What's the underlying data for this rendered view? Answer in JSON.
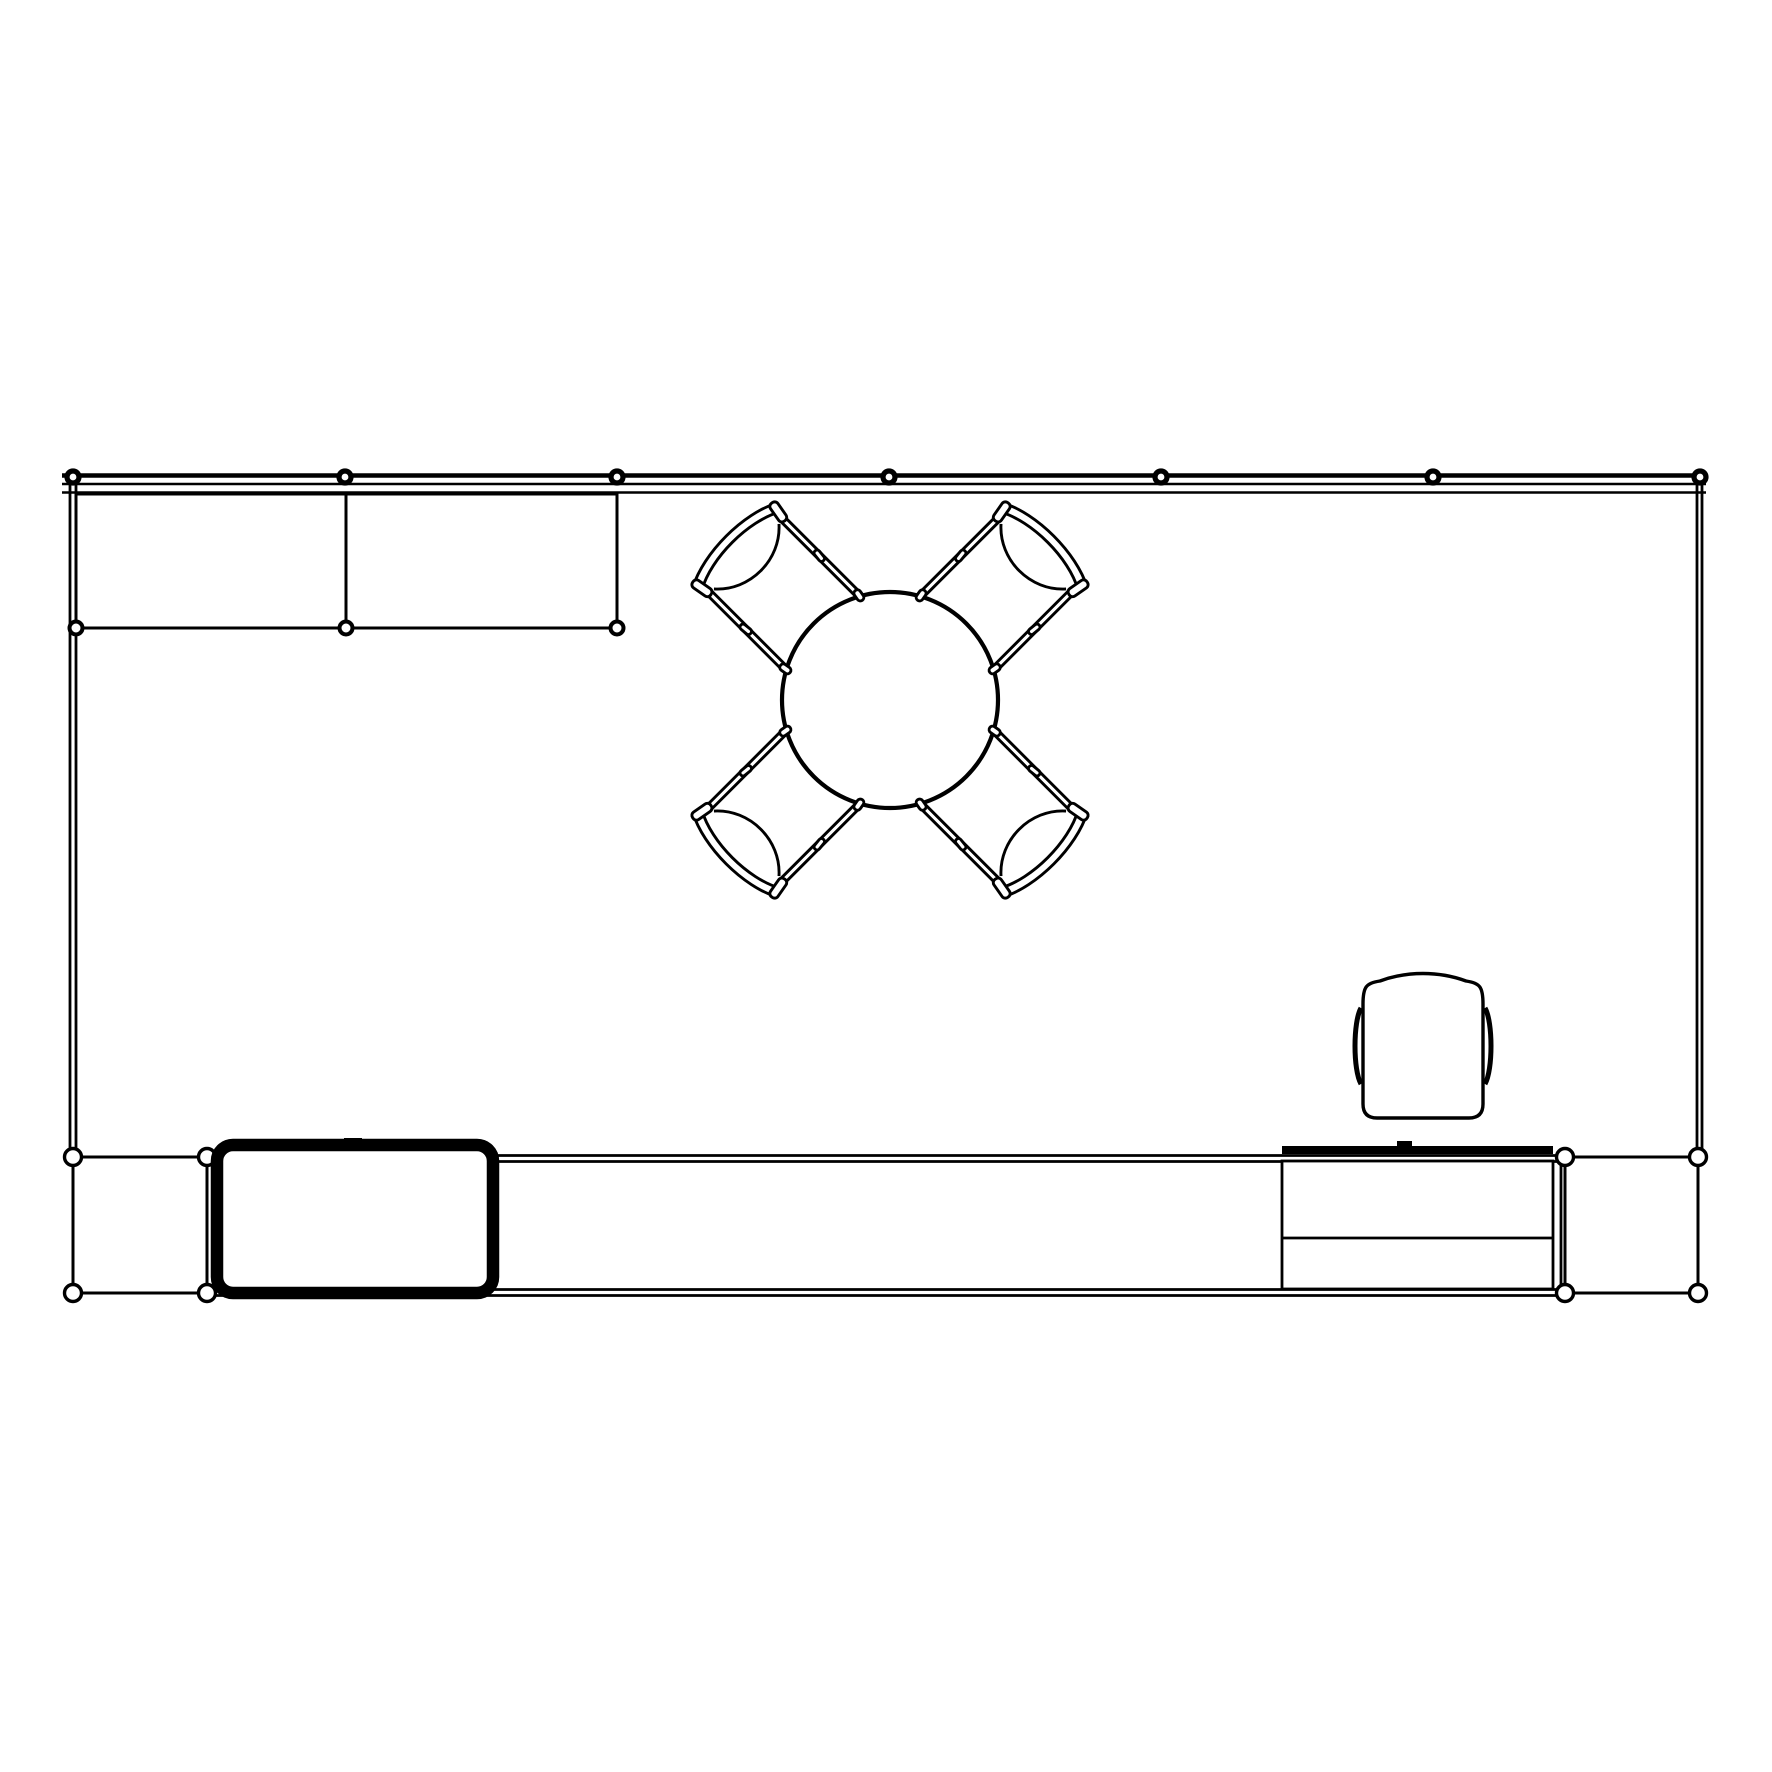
{
  "canvas": {
    "width": 1772,
    "height": 1772,
    "background": "#ffffff",
    "line_color": "#000000"
  },
  "room": {
    "top_wall": {
      "x1": 62,
      "x2": 1706,
      "lines": [
        {
          "y": 475.5,
          "w": 4.5
        },
        {
          "y": 484,
          "w": 2.6
        },
        {
          "y": 492.5,
          "w": 2.6
        }
      ]
    },
    "left_wall": {
      "y1": 477,
      "y2": 1157,
      "xs": [
        70,
        76
      ],
      "w": 2.8
    },
    "right_wall": {
      "y1": 477,
      "y2": 1157,
      "xs": [
        1697,
        1702
      ],
      "w": 2.8
    },
    "posts": {
      "y": 477,
      "r": 6,
      "stroke": 5.2,
      "xs": [
        73,
        345,
        617,
        889,
        1161,
        1433,
        1700
      ]
    }
  },
  "cabinets": {
    "x": 76,
    "y": 494,
    "width": 541,
    "height": 134,
    "divider_x": 346,
    "node_y": 628,
    "node_xs": [
      76,
      346,
      617
    ],
    "node_r": 6.5,
    "node_stroke": 4
  },
  "bottom_partition": {
    "x1": 207,
    "x2": 1565,
    "top_line_ys": [
      1155.5,
      1161.5
    ],
    "bottom_line_ys": [
      1289.5,
      1295.5
    ],
    "end_line_x": 1561,
    "left_panel": {
      "x": 73,
      "y": 1157,
      "width": 134,
      "height": 136
    },
    "right_panel": {
      "x": 1565,
      "y": 1157,
      "width": 133,
      "height": 136
    },
    "node_r": 8.5,
    "node_stroke": 3.4
  },
  "tv": {
    "x": 217,
    "y": 1145,
    "width": 276,
    "height": 148,
    "corner_radius": 16,
    "border": 12.5,
    "mount": {
      "x": 344,
      "y": 1138,
      "width": 18,
      "height": 8
    }
  },
  "desk": {
    "x": 1282,
    "y": 1161,
    "width": 271,
    "height": 128,
    "divider_y": 1238,
    "back_rail": {
      "x": 1282,
      "y": 1146,
      "width": 271,
      "height": 8
    },
    "grommet": {
      "x": 1397,
      "y": 1141,
      "width": 15,
      "height": 6
    }
  },
  "dining": {
    "table_cx": 890,
    "table_cy": 700,
    "table_r": 108,
    "table_stroke": 4.2,
    "chair_angles": [
      45,
      135,
      225,
      315
    ]
  },
  "desk_chair": {
    "left": 1363,
    "right": 1483,
    "top_y": 981,
    "apex_y": 973,
    "bottom": 1118,
    "shoulder_y": 1004,
    "corner_r": 14,
    "arm_top": 1008,
    "arm_bottom": 1084,
    "arm_bulge": 8
  }
}
